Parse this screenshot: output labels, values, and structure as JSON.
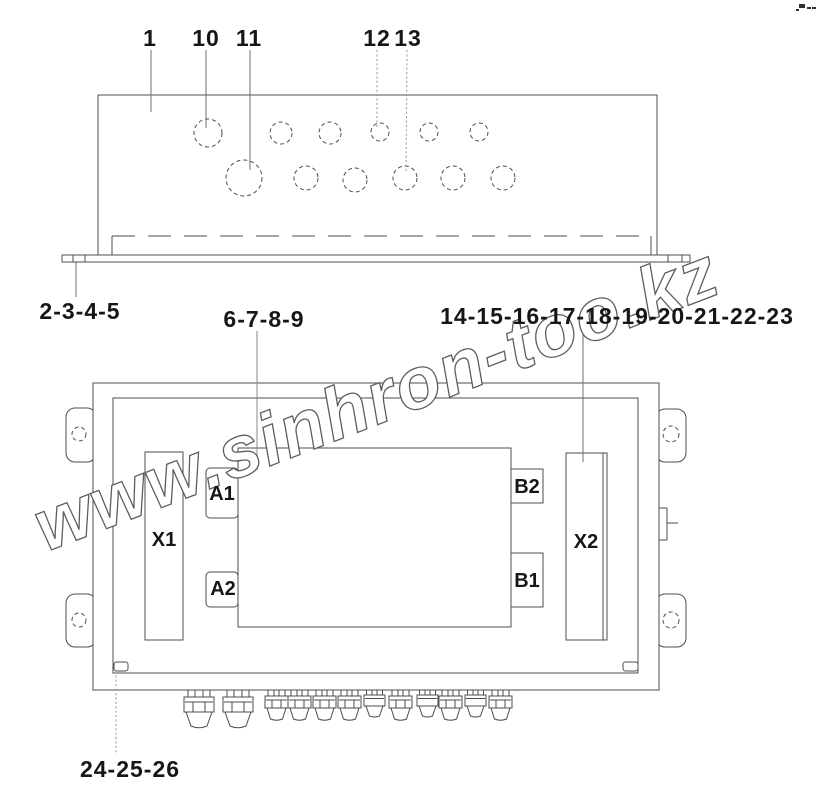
{
  "watermark": {
    "text": "www.sinhron-too.kz"
  },
  "callouts": {
    "item_1": "1",
    "item_10": "10",
    "item_11": "11",
    "item_12": "12",
    "item_13": "13",
    "items_2_5": "2-3-4-5",
    "items_6_9": "6-7-8-9",
    "items_14_23": "14-15-16-17-18-19-20-21-22-23",
    "items_24_26": "24-25-26"
  },
  "terminals": {
    "x1": "X1",
    "x2": "X2",
    "a1": "A1",
    "a2": "A2",
    "b1": "B1",
    "b2": "B2"
  },
  "colors": {
    "line": "#4d4d4d",
    "label": "#161616",
    "leader": "#9a9a9a",
    "watermark": "#5e5e5e",
    "background": "#ffffff"
  }
}
